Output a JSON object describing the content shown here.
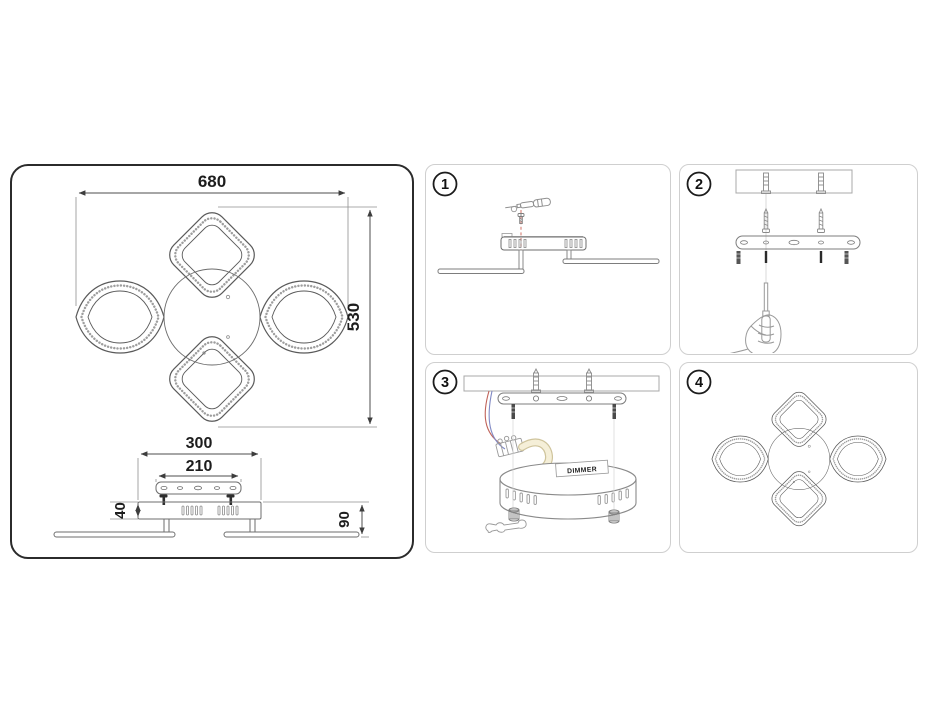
{
  "drawing": {
    "dimensions": {
      "fixture_width": "680",
      "fixture_height": "530",
      "canopy_width": "300",
      "bracket_width": "210",
      "canopy_height": "40",
      "mount_depth": "90"
    }
  },
  "steps": [
    {
      "number": "1"
    },
    {
      "number": "2"
    },
    {
      "number": "3"
    },
    {
      "number": "4"
    }
  ],
  "labels": {
    "dimmer": "DIMMER"
  },
  "colors": {
    "frame_border": "#2b2b2b",
    "panel_border": "#cfcfcf",
    "drawing_line": "#5a5a5a",
    "light_line": "#9a9a9a",
    "dashed_red": "#d98a80",
    "wire_red": "#c0635a",
    "wire_blue": "#8089c4",
    "cable_fill": "#f5efd8",
    "cable_edge": "#cfc49c"
  }
}
